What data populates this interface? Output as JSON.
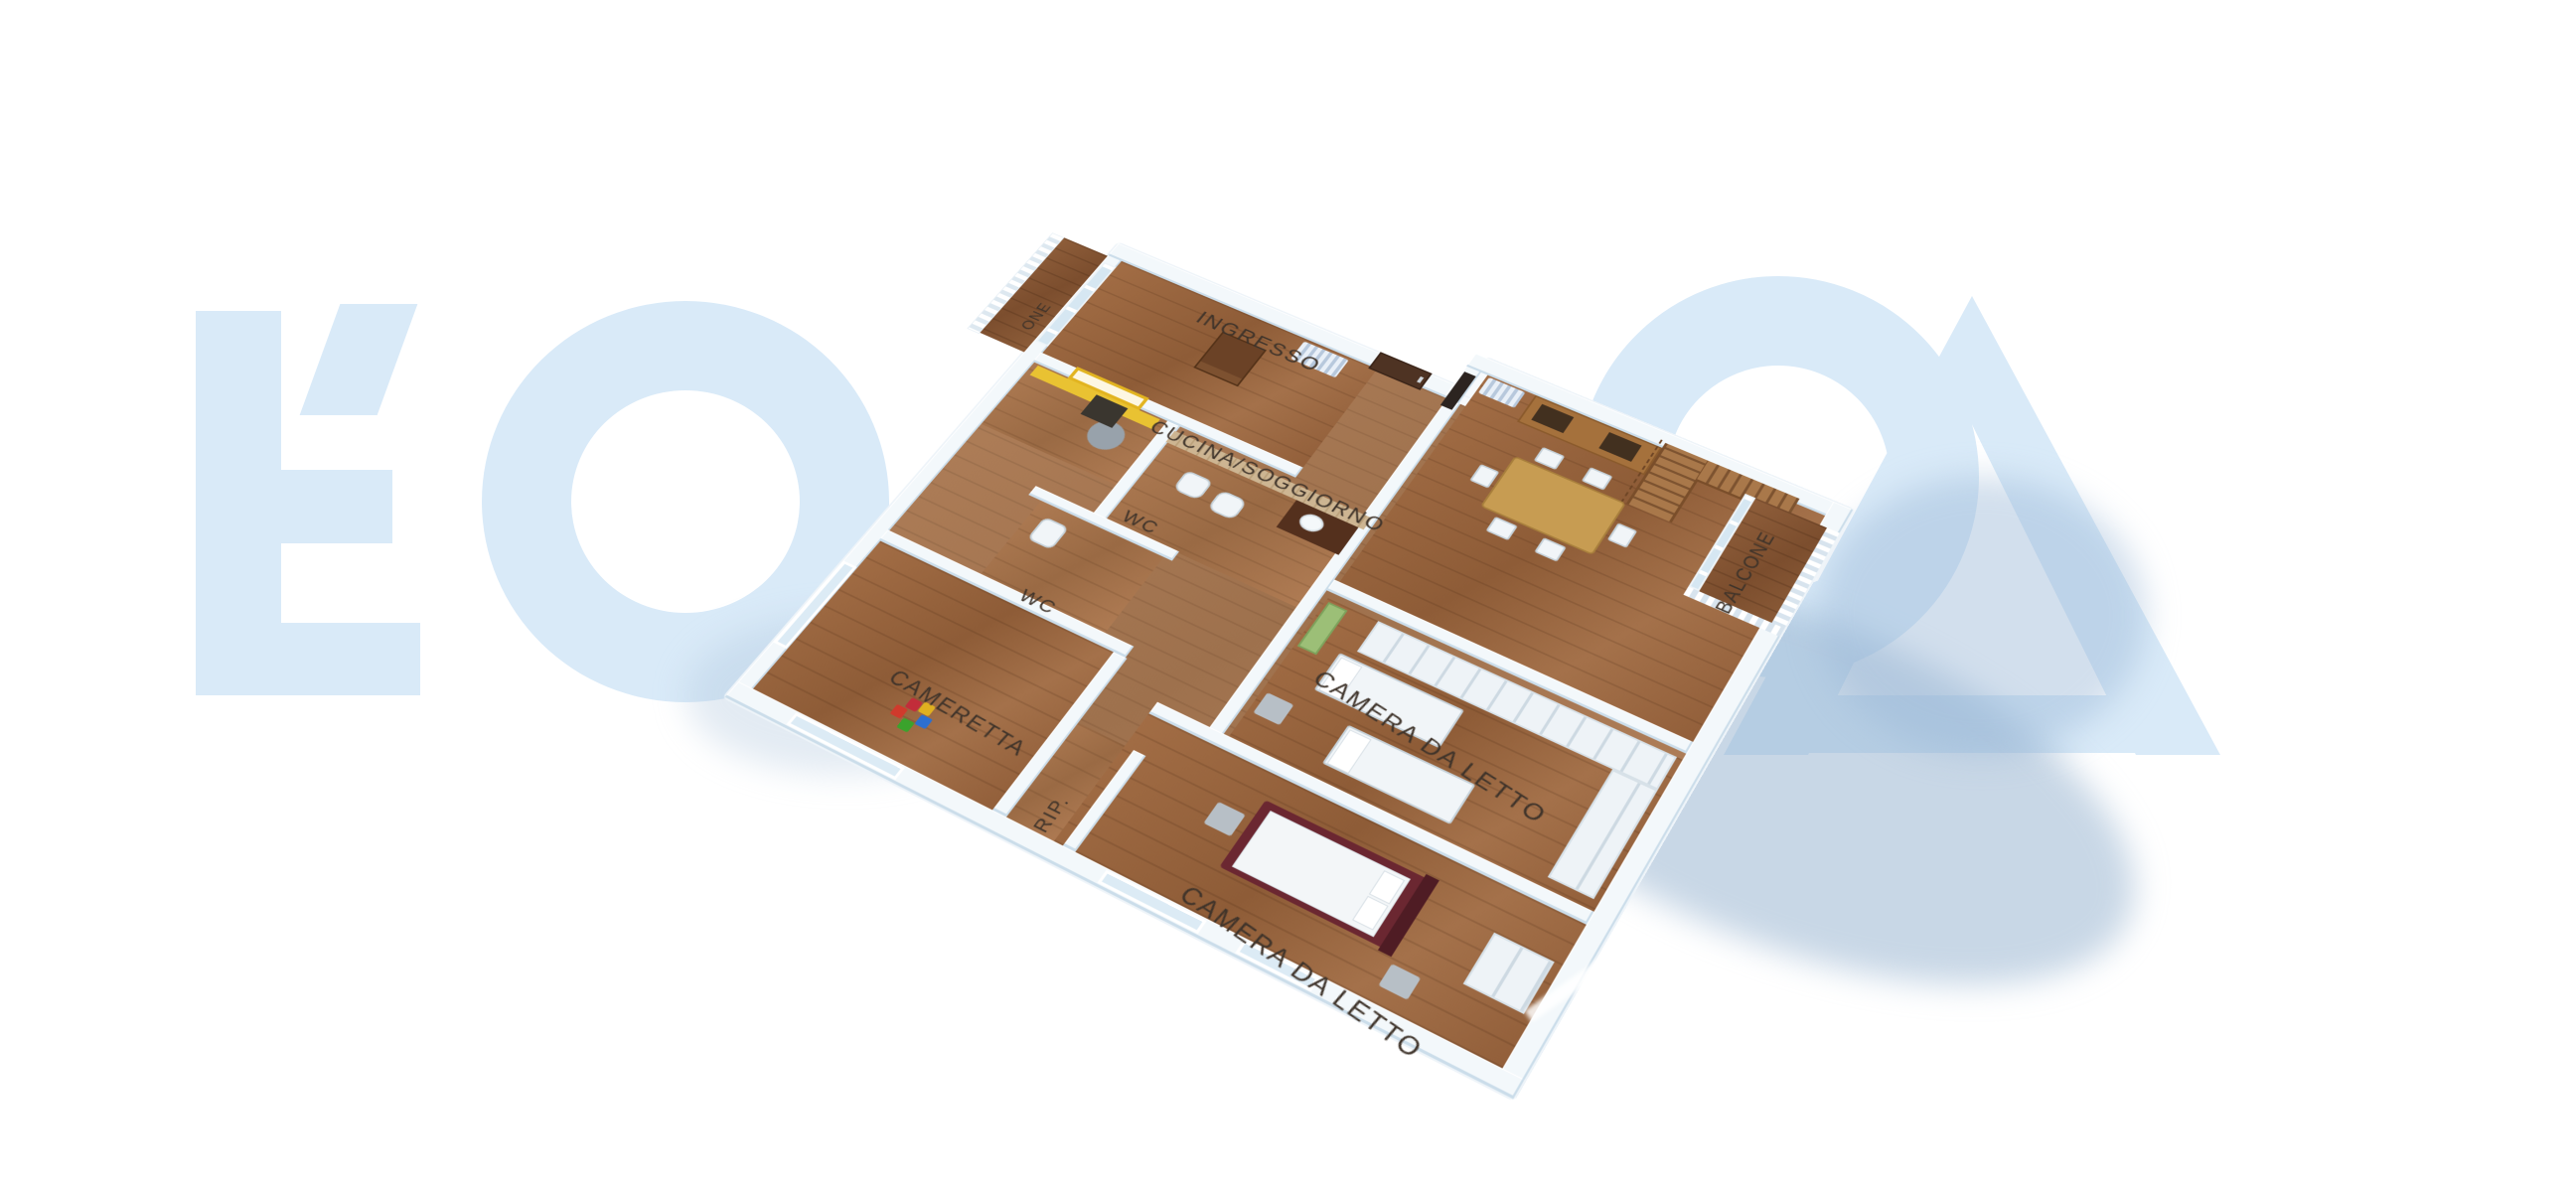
{
  "watermark": {
    "color": "#d9eaf8",
    "letters": [
      "Ľ",
      "O",
      "S",
      "A"
    ]
  },
  "plan": {
    "labels": {
      "ingresso": "INGRESSO",
      "cucina_soggiorno": "CUCINA/SOGGIORNO",
      "wc_upper": "WC",
      "wc_lower": "WC",
      "cameretta": "CAMERETTA",
      "ripostiglio": "RIP.",
      "camera_da_letto_1": "CAMERA DA LETTO",
      "camera_da_letto_2": "CAMERA DA LETTO",
      "balcone": "BALCONE",
      "balcone_partial": "ONE"
    },
    "colors": {
      "wall_top": "#f5f9fc",
      "wall_face": "#c9dcea",
      "wood_floor": "#9c6a43",
      "tile_wall": "#c9b18c",
      "accent_yellow": "#e9c232",
      "bed_frame_red": "#6b2731",
      "bench_green": "#9cbf77",
      "shadow_blue": "#b9cfe2",
      "label_text": "#3e332a"
    }
  }
}
